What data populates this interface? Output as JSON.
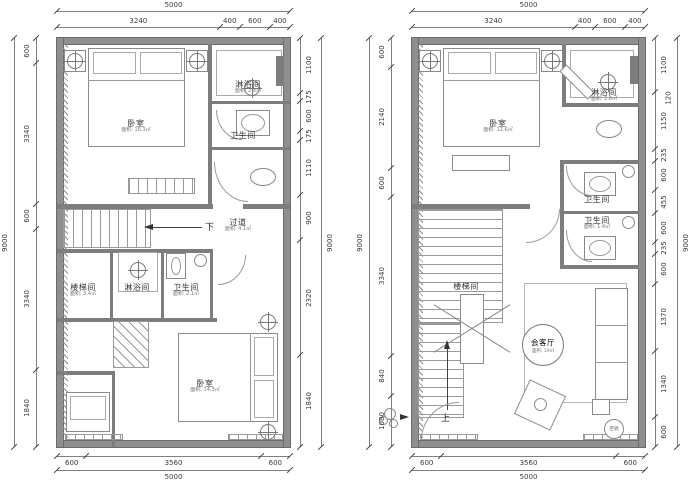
{
  "drawing": {
    "background": "#ffffff",
    "wall_color": "#8f8f8f",
    "line_color": "#8a8a8a",
    "dim_text_color": "#3a3a3a",
    "down_label": "下",
    "up_label": "上"
  },
  "plans": [
    {
      "id": "plan-left",
      "rooms": [
        {
          "label": "卧室",
          "area": "面积: 16.3㎡"
        },
        {
          "label": "淋浴间",
          "area": "面积: 2.8㎡"
        },
        {
          "label": "卫生间",
          "area": "面积: 2.5㎡"
        },
        {
          "label": "过道",
          "area": "面积: 4.1㎡"
        },
        {
          "label": "楼梯间",
          "area": "面积: 3.4㎡"
        },
        {
          "label": "淋浴间",
          "area": "面积: 2.8㎡"
        },
        {
          "label": "卫生间",
          "area": "面积: 2.1㎡"
        },
        {
          "label": "卧室",
          "area": "面积: 14.3㎡"
        }
      ],
      "dims": {
        "top_overall": [
          "5000"
        ],
        "top": [
          "3240",
          "400",
          "600",
          "400"
        ],
        "left_overall": [
          "9000"
        ],
        "left": [
          "600",
          "3340",
          "600",
          "3340",
          "1840"
        ],
        "right": [
          "1100",
          "175",
          "600",
          "175",
          "1110",
          "900",
          "2320",
          "1840"
        ],
        "right_overall": [
          "9000"
        ],
        "bottom": [
          "600",
          "3560",
          "600"
        ],
        "bottom_overall": [
          "5000"
        ]
      }
    },
    {
      "id": "plan-right",
      "rooms": [
        {
          "label": "卧室",
          "area": "面积: 12.6㎡"
        },
        {
          "label": "淋浴间",
          "area": "面积: 2.6㎡"
        },
        {
          "label": "卫生间",
          "area": "面积: 1.4㎡"
        },
        {
          "label": "卫生间",
          "area": "面积: 1.4㎡"
        },
        {
          "label": "楼梯间",
          "area": ""
        },
        {
          "label": "会客厅",
          "area": "面积: 19㎡"
        },
        {
          "label": "空调",
          "area": ""
        }
      ],
      "dims": {
        "top_overall": [
          "5000"
        ],
        "top": [
          "3240",
          "400",
          "600",
          "400"
        ],
        "left_overall": [
          "9000"
        ],
        "left": [
          "600",
          "2140",
          "600",
          "3340",
          "840",
          "1080"
        ],
        "right": [
          "1100",
          "1150",
          "235",
          "600",
          "455",
          "600",
          "235",
          "600",
          "1370",
          "1340",
          "600"
        ],
        "right_overall": [
          "9000"
        ],
        "right_secondary": "120",
        "bottom": [
          "600",
          "3560",
          "600"
        ],
        "bottom_overall": [
          "5000"
        ]
      }
    }
  ]
}
